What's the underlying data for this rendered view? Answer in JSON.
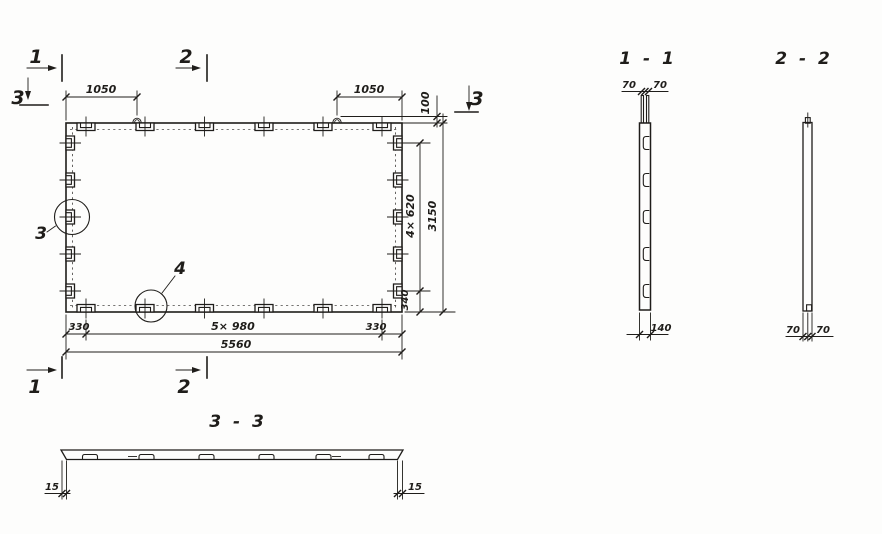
{
  "colors": {
    "ink": "#1f1d1a",
    "paper": "#fdfdfc"
  },
  "plan": {
    "section_marks": {
      "top_1": "1",
      "top_2": "2",
      "left_3": "3",
      "right_3": "3",
      "bottom_1": "1",
      "bottom_2": "2"
    },
    "detail_callouts": {
      "detail_3": "3",
      "detail_4": "4"
    },
    "dimensions": {
      "top_left_to_loop": "1050",
      "top_loop_to_right": "1050",
      "loop_height": "100",
      "right_tab_pitch": "4× 620",
      "right_bottom_margin": "340",
      "height_total": "3150",
      "bottom_left_margin": "330",
      "bottom_tab_pitch": "5× 980",
      "bottom_right_margin": "330",
      "length_total": "5560"
    }
  },
  "section_1_1": {
    "title": "1 - 1",
    "dim_left_70": "70",
    "dim_right_70": "70",
    "dim_rib_width": "140"
  },
  "section_2_2": {
    "title": "2 - 2",
    "dim_left_70": "70",
    "dim_right_70": "70"
  },
  "section_3_3": {
    "title": "3 - 3",
    "dim_left_15": "15",
    "dim_right_15": "15"
  }
}
